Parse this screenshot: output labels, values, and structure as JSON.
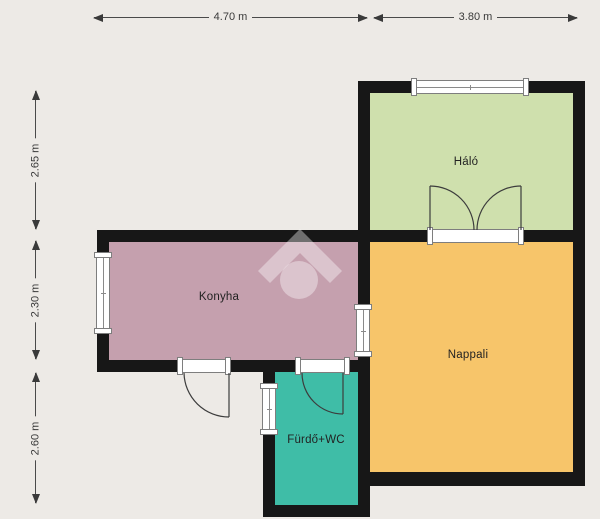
{
  "title": "Apartment floor plan",
  "colors": {
    "background": "#edeae6",
    "wall": "#171717",
    "window_frame": "#7e7e7e",
    "dimension": "#3a3a3a"
  },
  "rooms": [
    {
      "label": "Háló",
      "color": "#cfe0ad"
    },
    {
      "label": "Konyha",
      "color": "#c5a0ae"
    },
    {
      "label": "Nappali",
      "color": "#f7c56a"
    },
    {
      "label": "Fürdő+WC",
      "color": "#3fbda7"
    }
  ],
  "dimensions": {
    "top": [
      {
        "label": "4.70 m"
      },
      {
        "label": "3.80 m"
      }
    ],
    "left": [
      {
        "label": "2.65 m"
      },
      {
        "label": "2.30 m"
      },
      {
        "label": "2.60 m"
      }
    ]
  },
  "watermark": {
    "icon": "house-logo-watermark"
  }
}
